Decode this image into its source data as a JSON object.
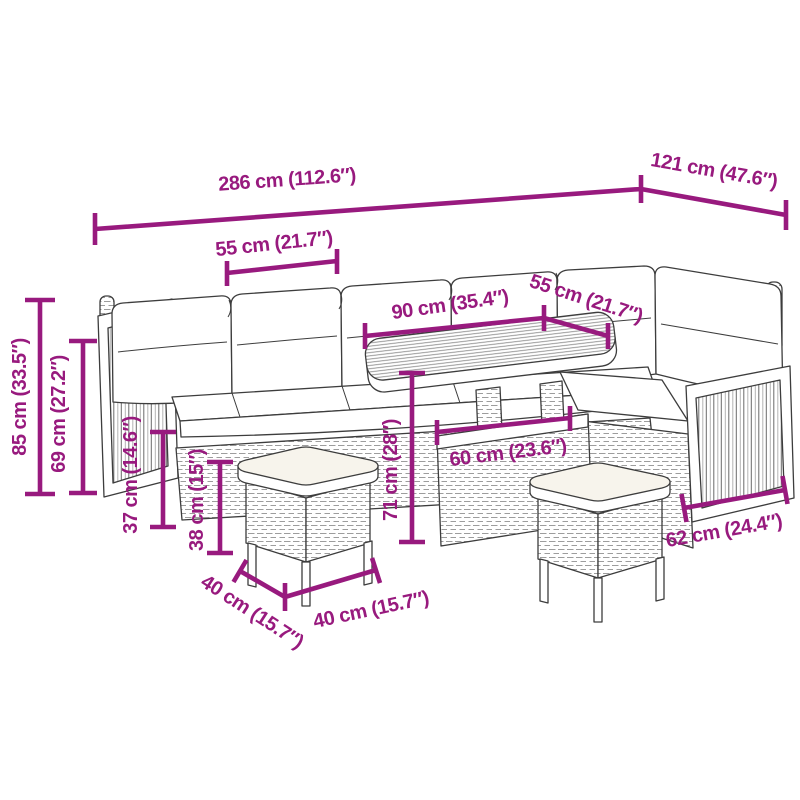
{
  "colors": {
    "dimension_accent": "#981a7e",
    "outline": "#3d3d3d",
    "cushion_fill": "#f7f4ec"
  },
  "dimensions": [
    {
      "id": "total-width",
      "label": "286 cm (112.6″)"
    },
    {
      "id": "total-depth",
      "label": "121 cm (47.6″)"
    },
    {
      "id": "left-seat-width",
      "label": "55 cm (21.7″)"
    },
    {
      "id": "table-length",
      "label": "90 cm (35.4″)"
    },
    {
      "id": "right-seat-width",
      "label": "55 cm (21.7″)"
    },
    {
      "id": "total-height",
      "label": "85 cm (33.5″)"
    },
    {
      "id": "backrest-height",
      "label": "69 cm (27.2″)"
    },
    {
      "id": "seat-height",
      "label": "37 cm (14.6″)"
    },
    {
      "id": "stool-height",
      "label": "38 cm (15″)"
    },
    {
      "id": "table-height",
      "label": "71 cm (28″)"
    },
    {
      "id": "table-base-width",
      "label": "60 cm (23.6″)"
    },
    {
      "id": "stool-depth",
      "label": "40 cm (15.7″)"
    },
    {
      "id": "stool-width",
      "label": "40 cm (15.7″)"
    },
    {
      "id": "armrest-panel-width",
      "label": "62 cm (24.4″)"
    }
  ]
}
